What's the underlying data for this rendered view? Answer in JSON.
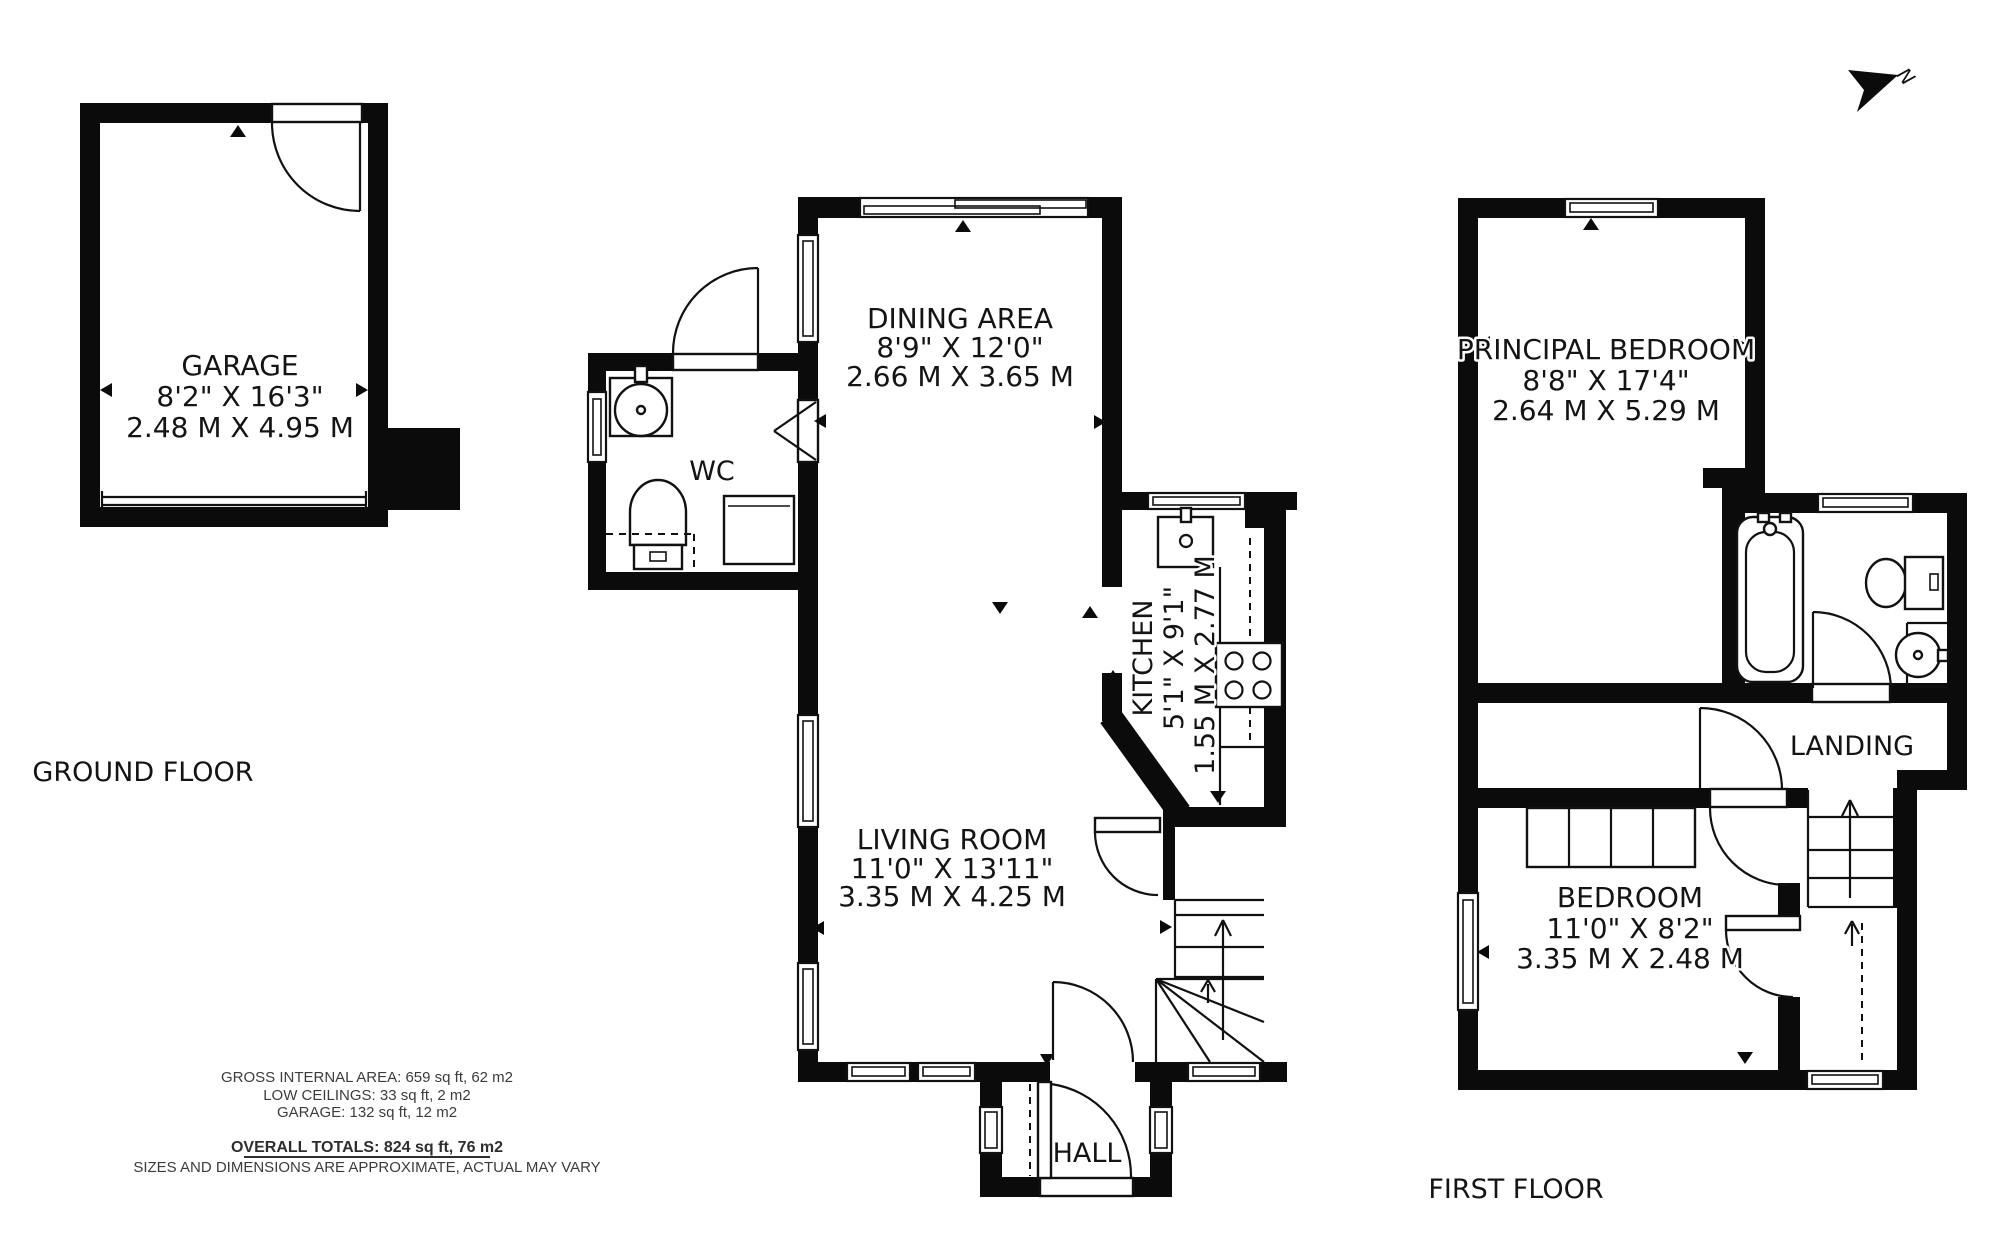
{
  "north": {
    "label": "N"
  },
  "ground_floor": {
    "label": "GROUND FLOOR",
    "garage": {
      "name": "GARAGE",
      "imperial": "8'2\" X 16'3\"",
      "metric": "2.48 M X 4.95 M"
    },
    "wc": {
      "name": "WC"
    },
    "dining": {
      "name": "DINING AREA",
      "imperial": "8'9\" X 12'0\"",
      "metric": "2.66 M X 3.65 M"
    },
    "kitchen": {
      "name": "KITCHEN",
      "imperial": "5'1\" X 9'1\"",
      "metric": "1.55 M X 2.77 M"
    },
    "living": {
      "name": "LIVING ROOM",
      "imperial": "11'0\" X 13'11\"",
      "metric": "3.35 M X 4.25 M"
    },
    "hall": {
      "name": "HALL"
    }
  },
  "first_floor": {
    "label": "FIRST FLOOR",
    "principal_bedroom": {
      "name": "PRINCIPAL BEDROOM",
      "imperial": "8'8\" X 17'4\"",
      "metric": "2.64 M X 5.29 M"
    },
    "landing": {
      "name": "LANDING"
    },
    "bedroom": {
      "name": "BEDROOM",
      "imperial": "11'0\" X 8'2\"",
      "metric": "3.35 M X 2.48 M"
    }
  },
  "summary": {
    "gross": "GROSS INTERNAL AREA:  659 sq ft, 62 m2",
    "low_ceilings": "LOW CEILINGS:  33 sq ft, 2 m2",
    "garage": "GARAGE: 132 sq ft, 12 m2",
    "totals": "OVERALL TOTALS: 824 sq ft, 76  m2",
    "disclaimer": "SIZES AND DIMENSIONS ARE APPROXIMATE, ACTUAL MAY VARY"
  }
}
